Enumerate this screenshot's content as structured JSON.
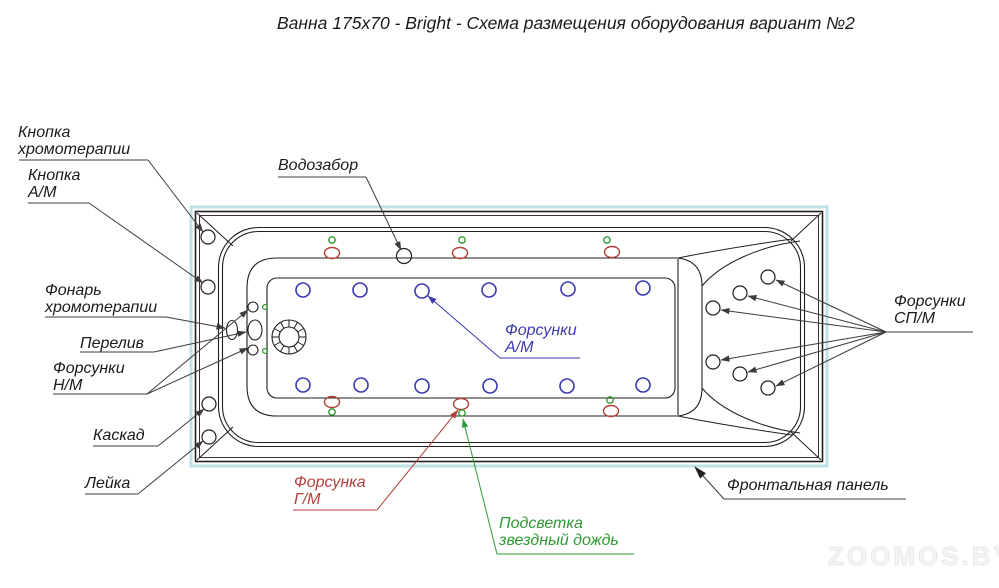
{
  "title": "Ванна 175х70 - Bright - Схема размещения оборудования вариант №2",
  "labels": {
    "chromo_button": {
      "line1": "Кнопка",
      "line2": "хромотерапии"
    },
    "am_button": {
      "line1": "Кнопка",
      "line2": "А/М"
    },
    "chromo_light": {
      "line1": "Фонарь",
      "line2": "хромотерапии"
    },
    "overflow": "Перелив",
    "nozzles_nm": {
      "line1": "Форсунки",
      "line2": "Н/М"
    },
    "cascade": "Каскад",
    "shower_head": "Лейка",
    "water_intake": "Водозабор",
    "nozzles_am": {
      "line1": "Форсунки",
      "line2": "А/М"
    },
    "nozzles_spm": {
      "line1": "Форсунки",
      "line2": "СП/М"
    },
    "nozzle_gm": {
      "line1": "Форсунка",
      "line2": "Г/М"
    },
    "backlight": {
      "line1": "Подсветка",
      "line2": "звездный дождь"
    },
    "front_panel": "Фронтальная панель"
  },
  "watermark": "ZOOMOS.BY",
  "equipment_counts": {
    "am_jets": 12,
    "spm_jets": 6,
    "gm_jets": 6,
    "nm_jets": 2,
    "backlight_dots": 6,
    "rim_buttons": 4
  },
  "colors": {
    "am_blue": "#3a3ab0",
    "gm_red": "#b2403a",
    "backlight_green": "#2f9a33",
    "outline_black": "#1f1f1f",
    "tub_edge_cyan": "#bfe2e8",
    "leader_gray": "#3c3c3c",
    "text_black": "#1a1a1a"
  }
}
